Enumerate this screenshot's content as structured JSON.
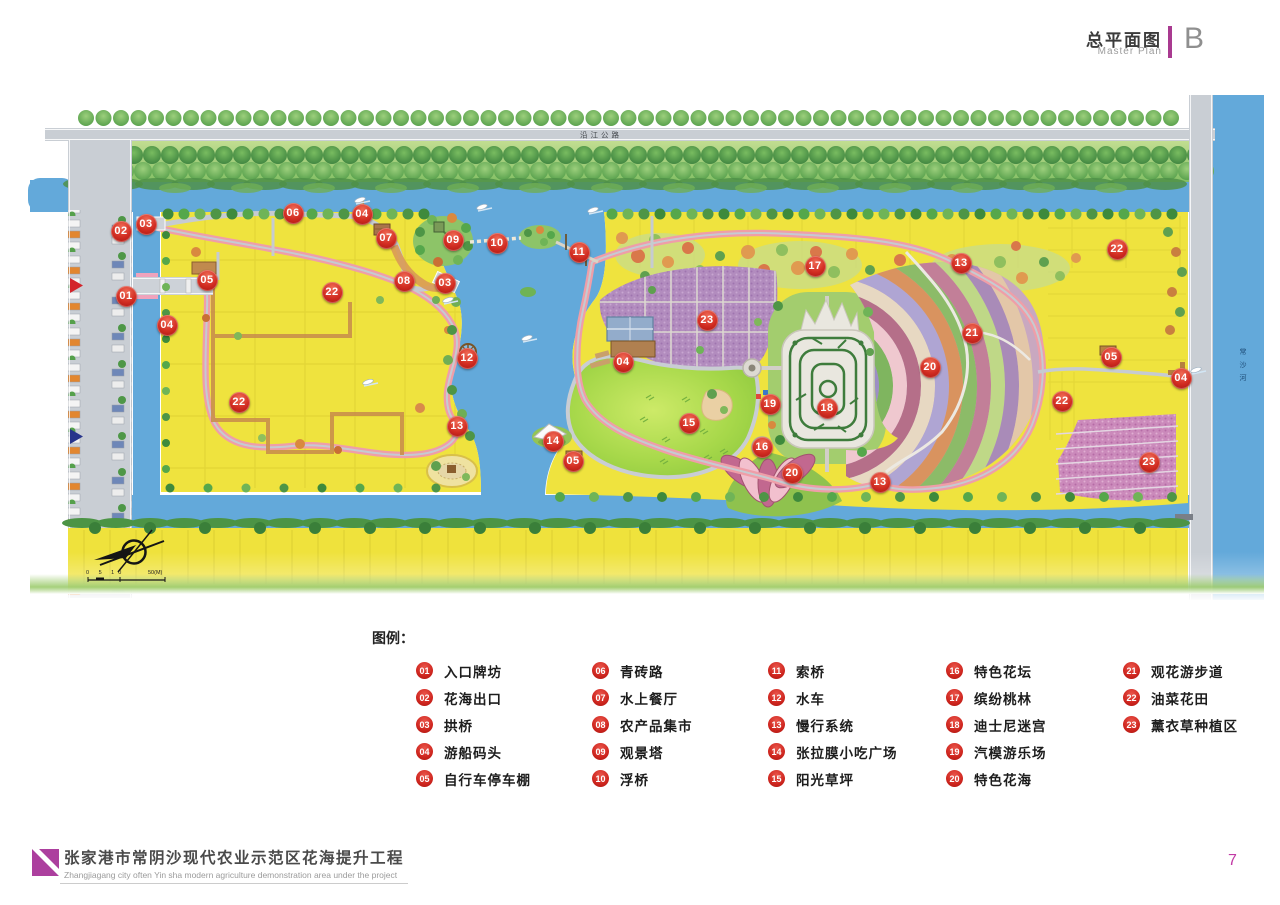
{
  "header": {
    "title_cn": "总平面图",
    "title_en": "Master Plan",
    "badge": "B"
  },
  "map": {
    "road_label": "沿江公路",
    "river_label": "常沙河",
    "scale_ticks": "0 5 10",
    "scale_unit": "50(M)",
    "compass": "north-arrow",
    "markers": [
      {
        "num": "01",
        "x": 126,
        "y": 296
      },
      {
        "num": "02",
        "x": 121,
        "y": 231
      },
      {
        "num": "03",
        "x": 146,
        "y": 224
      },
      {
        "num": "03",
        "x": 445,
        "y": 283
      },
      {
        "num": "04",
        "x": 167,
        "y": 325
      },
      {
        "num": "04",
        "x": 362,
        "y": 214
      },
      {
        "num": "04",
        "x": 623,
        "y": 362
      },
      {
        "num": "04",
        "x": 1181,
        "y": 378
      },
      {
        "num": "05",
        "x": 207,
        "y": 280
      },
      {
        "num": "05",
        "x": 573,
        "y": 461
      },
      {
        "num": "05",
        "x": 1111,
        "y": 357
      },
      {
        "num": "06",
        "x": 293,
        "y": 213
      },
      {
        "num": "07",
        "x": 386,
        "y": 238
      },
      {
        "num": "08",
        "x": 404,
        "y": 281
      },
      {
        "num": "09",
        "x": 453,
        "y": 240
      },
      {
        "num": "10",
        "x": 497,
        "y": 243
      },
      {
        "num": "11",
        "x": 579,
        "y": 252
      },
      {
        "num": "12",
        "x": 467,
        "y": 358
      },
      {
        "num": "13",
        "x": 457,
        "y": 426
      },
      {
        "num": "13",
        "x": 961,
        "y": 263
      },
      {
        "num": "13",
        "x": 880,
        "y": 482
      },
      {
        "num": "14",
        "x": 553,
        "y": 441
      },
      {
        "num": "15",
        "x": 689,
        "y": 423
      },
      {
        "num": "16",
        "x": 762,
        "y": 447
      },
      {
        "num": "17",
        "x": 815,
        "y": 266
      },
      {
        "num": "18",
        "x": 827,
        "y": 408
      },
      {
        "num": "19",
        "x": 770,
        "y": 404
      },
      {
        "num": "20",
        "x": 930,
        "y": 367
      },
      {
        "num": "20",
        "x": 792,
        "y": 473
      },
      {
        "num": "21",
        "x": 972,
        "y": 333
      },
      {
        "num": "22",
        "x": 332,
        "y": 292
      },
      {
        "num": "22",
        "x": 239,
        "y": 402
      },
      {
        "num": "22",
        "x": 1117,
        "y": 249
      },
      {
        "num": "22",
        "x": 1062,
        "y": 401
      },
      {
        "num": "23",
        "x": 707,
        "y": 320
      },
      {
        "num": "23",
        "x": 1149,
        "y": 462
      }
    ]
  },
  "legend": {
    "title": "图例：",
    "columns": [
      [
        {
          "num": "01",
          "label": "入口牌坊"
        },
        {
          "num": "02",
          "label": "花海出口"
        },
        {
          "num": "03",
          "label": "拱桥"
        },
        {
          "num": "04",
          "label": "游船码头"
        },
        {
          "num": "05",
          "label": "自行车停车棚"
        }
      ],
      [
        {
          "num": "06",
          "label": "青砖路"
        },
        {
          "num": "07",
          "label": "水上餐厅"
        },
        {
          "num": "08",
          "label": "农产品集市"
        },
        {
          "num": "09",
          "label": "观景塔"
        },
        {
          "num": "10",
          "label": "浮桥"
        }
      ],
      [
        {
          "num": "11",
          "label": "索桥"
        },
        {
          "num": "12",
          "label": "水车"
        },
        {
          "num": "13",
          "label": "慢行系统"
        },
        {
          "num": "14",
          "label": "张拉膜小吃广场"
        },
        {
          "num": "15",
          "label": "阳光草坪"
        }
      ],
      [
        {
          "num": "16",
          "label": "特色花坛"
        },
        {
          "num": "17",
          "label": "缤纷桃林"
        },
        {
          "num": "18",
          "label": "迪士尼迷宫"
        },
        {
          "num": "19",
          "label": "汽模游乐场"
        },
        {
          "num": "20",
          "label": "特色花海"
        }
      ],
      [
        {
          "num": "21",
          "label": "观花游步道"
        },
        {
          "num": "22",
          "label": "油菜花田"
        },
        {
          "num": "23",
          "label": "薰衣草种植区"
        }
      ]
    ],
    "column_x": [
      416,
      592,
      768,
      946,
      1123
    ]
  },
  "footer": {
    "title_cn": "张家港市常阴沙现代农业示范区花海提升工程",
    "title_en": "Zhangjiagang city often Yin sha modern agriculture demonstration area under the project",
    "page": "7"
  },
  "colors": {
    "accent": "#A93A90",
    "marker_red": "#D22D22",
    "water": "#63A9DA",
    "field_yellow": "#EFE23C"
  }
}
